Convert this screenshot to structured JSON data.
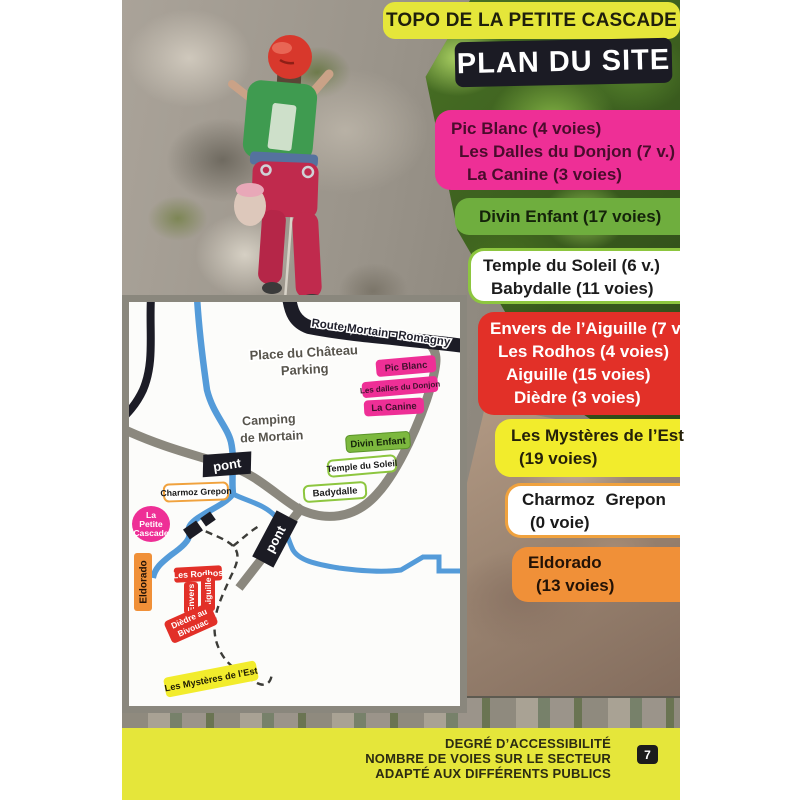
{
  "header": {
    "topo_title": "TOPO DE LA PETITE CASCADE",
    "plan_title": "PLAN DU SITE"
  },
  "sectors": {
    "pink": {
      "lines": [
        "Pic Blanc (4 voies)",
        "Les Dalles du Donjon (7 v.)",
        "La Canine (3 voies)"
      ]
    },
    "green": {
      "lines": [
        "Divin Enfant (17 voies)"
      ]
    },
    "white_green": {
      "lines": [
        "Temple du Soleil (6 v.)",
        "Babydalle (11 voies)"
      ]
    },
    "red": {
      "lines": [
        "Envers de l’Aiguille (7 v.)",
        "Les Rodhos (4 voies)",
        "Aiguille (15 voies)",
        "Dièdre (3 voies)"
      ]
    },
    "yellow": {
      "lines": [
        "Les Mystères de l’Est",
        "(19 voies)"
      ]
    },
    "white_orange": {
      "lines": [
        "Charmoz Grepon",
        "(0 voie)"
      ]
    },
    "orange": {
      "lines": [
        "Eldorado",
        "(13 voies)"
      ]
    }
  },
  "map": {
    "route": "Route Mortain - Romagny",
    "place_line1": "Place du Château",
    "place_line2": "Parking",
    "camping_line1": "Camping",
    "camping_line2": "de Mortain",
    "pont": "pont",
    "labels": {
      "pic_blanc": "Pic Blanc",
      "dalles_donjon": "Les dalles du Donjon",
      "la_canine": "La Canine",
      "divin_enfant": "Divin Enfant",
      "temple_soleil": "Temple du Soleil",
      "badydalle": "Badydalle",
      "charmoz_grepon": "Charmoz Grepon",
      "cascade_line1": "La",
      "cascade_line2": "Petite",
      "cascade_line3": "Cascade",
      "eldorado": "Eldorado",
      "les_rodhos": "Les Rodhos",
      "envers": "Envers",
      "aiguille": "Aiguille",
      "diedre_line1": "Dièdre au",
      "diedre_line2": "Bivouac",
      "mysteres": "Les Mystères de l’Est"
    }
  },
  "footer": {
    "lines": [
      "DEGRÉ D’ACCESSIBILITÉ",
      "NOMBRE DE VOIES SUR LE SECTEUR",
      "ADAPTÉ AUX DIFFÉRENTS PUBLICS"
    ],
    "page_number": "7"
  },
  "colors": {
    "yellow": "#e5e63a",
    "pink": "#ee2f96",
    "green": "#6fae3e",
    "red": "#e23028",
    "orange": "#f09038",
    "black_banner": "#1b1b24",
    "road_gray": "#8b887e",
    "river_blue": "#549bd9",
    "border_green": "#8dc63f",
    "border_orange": "#f0a23e"
  }
}
